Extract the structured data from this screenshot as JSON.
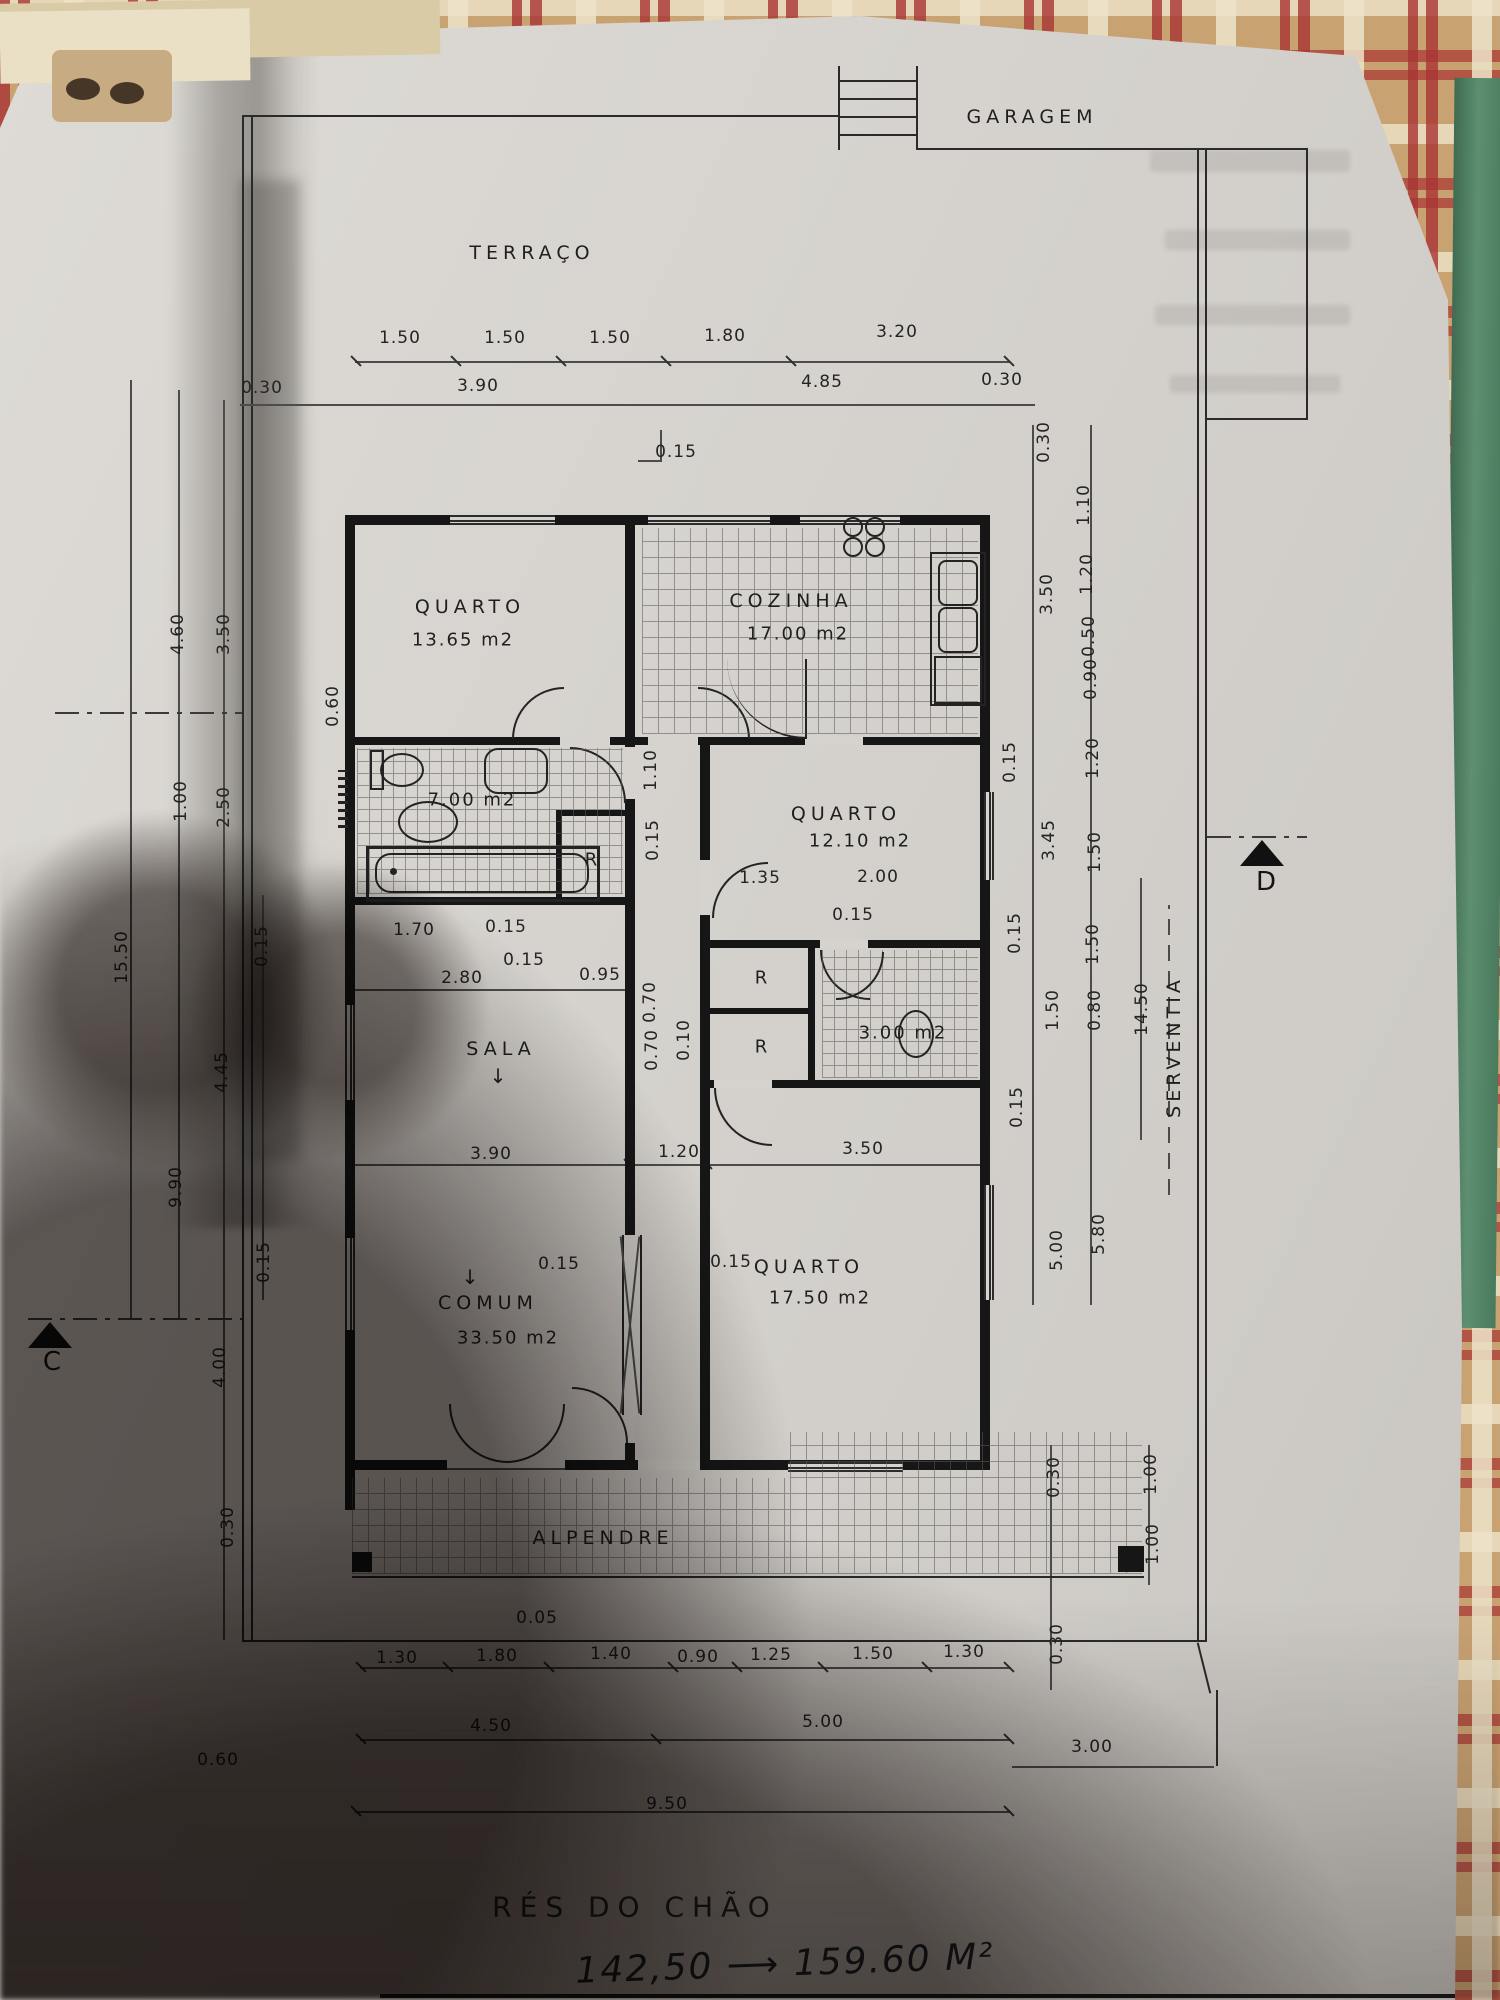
{
  "photo": {
    "plan_title": "RÉS DO CHÃO",
    "handwritten_note": "142,50 ⟶ 159.60 M²"
  },
  "colors": {
    "paper": "#d6d3ce",
    "ink": "#161616",
    "tablecloth_red": "#a83432",
    "tablecloth_tan": "#c9a272",
    "mat_green": "#5d8f70"
  },
  "markers": {
    "c": "C",
    "d": "D"
  },
  "rooms": {
    "garagem": {
      "name": "GARAGEM"
    },
    "terraco": {
      "name": "TERRAÇO"
    },
    "quarto1": {
      "name": "QUARTO",
      "area": "13.65 m2"
    },
    "cozinha": {
      "name": "COZINHA",
      "area": "17.00 m2"
    },
    "banho": {
      "area": "7.00 m2"
    },
    "quarto2": {
      "name": "QUARTO",
      "area": "12.10 m2"
    },
    "sala": {
      "name": "SALA"
    },
    "comum": {
      "name": "COMUM",
      "area": "33.50 m2"
    },
    "quarto3": {
      "name": "QUARTO",
      "area": "17.50 m2"
    },
    "wc": {
      "area": "3.00 m2"
    },
    "alpendre": {
      "name": "ALPENDRE"
    },
    "serventia": {
      "name": "SERVENTIA"
    },
    "closet1": {
      "name": "R"
    },
    "closet2": {
      "name": "R"
    },
    "closet3": {
      "name": "R"
    }
  },
  "dim_labels": [
    {
      "t": "1.50",
      "x": 400,
      "y": 338,
      "r": 0
    },
    {
      "t": "1.50",
      "x": 505,
      "y": 338,
      "r": 0
    },
    {
      "t": "1.50",
      "x": 610,
      "y": 338,
      "r": 0
    },
    {
      "t": "1.80",
      "x": 725,
      "y": 336,
      "r": 0
    },
    {
      "t": "3.20",
      "x": 897,
      "y": 332,
      "r": 0
    },
    {
      "t": "0.30",
      "x": 262,
      "y": 388,
      "r": 0
    },
    {
      "t": "3.90",
      "x": 478,
      "y": 386,
      "r": 0
    },
    {
      "t": "4.85",
      "x": 822,
      "y": 382,
      "r": 0
    },
    {
      "t": "0.30",
      "x": 1002,
      "y": 380,
      "r": 0
    },
    {
      "t": "0.15",
      "x": 676,
      "y": 452,
      "r": 0
    },
    {
      "t": "15.50",
      "x": 122,
      "y": 957,
      "r": 1
    },
    {
      "t": "4.60",
      "x": 178,
      "y": 634,
      "r": 1
    },
    {
      "t": "3.50",
      "x": 224,
      "y": 634,
      "r": 1
    },
    {
      "t": "1.00",
      "x": 181,
      "y": 801,
      "r": 1
    },
    {
      "t": "2.50",
      "x": 224,
      "y": 807,
      "r": 1
    },
    {
      "t": "0.15",
      "x": 262,
      "y": 946,
      "r": 1
    },
    {
      "t": "4.45",
      "x": 222,
      "y": 1072,
      "r": 1
    },
    {
      "t": "9.90",
      "x": 176,
      "y": 1187,
      "r": 1
    },
    {
      "t": "0.15",
      "x": 264,
      "y": 1262,
      "r": 1
    },
    {
      "t": "4.00",
      "x": 220,
      "y": 1367,
      "r": 1
    },
    {
      "t": "0.30",
      "x": 228,
      "y": 1527,
      "r": 1
    },
    {
      "t": "0.60",
      "x": 218,
      "y": 1760,
      "r": 0
    },
    {
      "t": "0.60",
      "x": 333,
      "y": 706,
      "r": 1
    },
    {
      "t": "1.70",
      "x": 414,
      "y": 930,
      "r": 0
    },
    {
      "t": "0.15",
      "x": 506,
      "y": 927,
      "r": 0
    },
    {
      "t": "0.15",
      "x": 524,
      "y": 960,
      "r": 0
    },
    {
      "t": "2.80",
      "x": 462,
      "y": 978,
      "r": 0
    },
    {
      "t": "0.95",
      "x": 600,
      "y": 975,
      "r": 0
    },
    {
      "t": "1.10",
      "x": 651,
      "y": 770,
      "r": 1
    },
    {
      "t": "0.15",
      "x": 653,
      "y": 840,
      "r": 1
    },
    {
      "t": "1.35",
      "x": 760,
      "y": 878,
      "r": 0
    },
    {
      "t": "2.00",
      "x": 878,
      "y": 877,
      "r": 0
    },
    {
      "t": "0.15",
      "x": 853,
      "y": 915,
      "r": 0
    },
    {
      "t": "0.70",
      "x": 650,
      "y": 1002,
      "r": 1
    },
    {
      "t": "0.70",
      "x": 652,
      "y": 1050,
      "r": 1
    },
    {
      "t": "0.10",
      "x": 684,
      "y": 1040,
      "r": 1
    },
    {
      "t": "3.90",
      "x": 491,
      "y": 1154,
      "r": 0
    },
    {
      "t": "1.20",
      "x": 679,
      "y": 1152,
      "r": 0
    },
    {
      "t": "3.50",
      "x": 863,
      "y": 1149,
      "r": 0
    },
    {
      "t": "0.15",
      "x": 559,
      "y": 1264,
      "r": 0
    },
    {
      "t": "0.15",
      "x": 731,
      "y": 1262,
      "r": 0
    },
    {
      "t": "0.05",
      "x": 537,
      "y": 1618,
      "r": 0
    },
    {
      "t": "1.30",
      "x": 397,
      "y": 1658,
      "r": 0
    },
    {
      "t": "1.80",
      "x": 497,
      "y": 1656,
      "r": 0
    },
    {
      "t": "1.40",
      "x": 611,
      "y": 1654,
      "r": 0
    },
    {
      "t": "0.90",
      "x": 698,
      "y": 1657,
      "r": 0
    },
    {
      "t": "1.25",
      "x": 771,
      "y": 1655,
      "r": 0
    },
    {
      "t": "1.50",
      "x": 873,
      "y": 1654,
      "r": 0
    },
    {
      "t": "1.30",
      "x": 964,
      "y": 1652,
      "r": 0
    },
    {
      "t": "4.50",
      "x": 491,
      "y": 1726,
      "r": 0
    },
    {
      "t": "5.00",
      "x": 823,
      "y": 1722,
      "r": 0
    },
    {
      "t": "9.50",
      "x": 667,
      "y": 1804,
      "r": 0
    },
    {
      "t": "3.00",
      "x": 1092,
      "y": 1747,
      "r": 0
    },
    {
      "t": "0.30",
      "x": 1044,
      "y": 442,
      "r": 1
    },
    {
      "t": "3.50",
      "x": 1047,
      "y": 594,
      "r": 1
    },
    {
      "t": "0.15",
      "x": 1010,
      "y": 762,
      "r": 1
    },
    {
      "t": "3.45",
      "x": 1049,
      "y": 840,
      "r": 1
    },
    {
      "t": "0.15",
      "x": 1015,
      "y": 933,
      "r": 1
    },
    {
      "t": "1.50",
      "x": 1053,
      "y": 1010,
      "r": 1
    },
    {
      "t": "0.15",
      "x": 1017,
      "y": 1107,
      "r": 1
    },
    {
      "t": "5.00",
      "x": 1057,
      "y": 1250,
      "r": 1
    },
    {
      "t": "1.10",
      "x": 1084,
      "y": 505,
      "r": 1
    },
    {
      "t": "1.20",
      "x": 1087,
      "y": 574,
      "r": 1
    },
    {
      "t": "0.50",
      "x": 1089,
      "y": 636,
      "r": 1
    },
    {
      "t": "0.90",
      "x": 1091,
      "y": 679,
      "r": 1
    },
    {
      "t": "1.20",
      "x": 1093,
      "y": 758,
      "r": 1
    },
    {
      "t": "1.50",
      "x": 1095,
      "y": 852,
      "r": 1
    },
    {
      "t": "1.50",
      "x": 1093,
      "y": 944,
      "r": 1
    },
    {
      "t": "0.80",
      "x": 1095,
      "y": 1010,
      "r": 1
    },
    {
      "t": "5.80",
      "x": 1099,
      "y": 1234,
      "r": 1
    },
    {
      "t": "14.50",
      "x": 1142,
      "y": 1009,
      "r": 1
    },
    {
      "t": "0.30",
      "x": 1054,
      "y": 1477,
      "r": 1
    },
    {
      "t": "1.00",
      "x": 1151,
      "y": 1474,
      "r": 1
    },
    {
      "t": "1.00",
      "x": 1153,
      "y": 1544,
      "r": 1
    },
    {
      "t": "0.30",
      "x": 1057,
      "y": 1644,
      "r": 1
    }
  ]
}
